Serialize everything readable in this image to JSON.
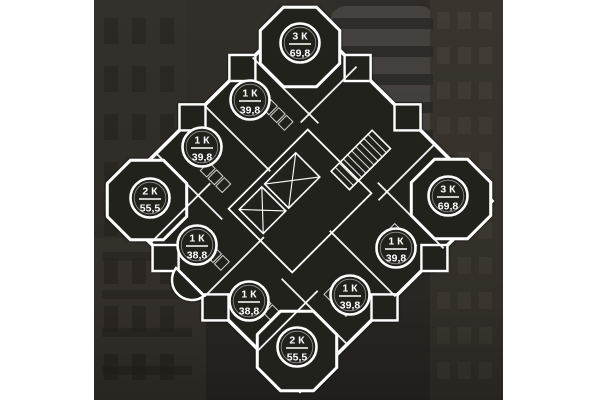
{
  "background": {
    "canvas": "#ffffff",
    "photo_base": "#2e2b28",
    "photo_left": 94,
    "photo_right": 503
  },
  "plan": {
    "colors": {
      "wall": "#ffffff",
      "interior": "#24211f",
      "text": "#ffffff"
    },
    "apartments": [
      {
        "rooms": "3 К",
        "area": "69,8",
        "cx": 300,
        "cy": 43
      },
      {
        "rooms": "1 К",
        "area": "39,8",
        "cx": 250,
        "cy": 100
      },
      {
        "rooms": "1 К",
        "area": "39,8",
        "cx": 202,
        "cy": 147
      },
      {
        "rooms": "2 К",
        "area": "55,5",
        "cx": 150,
        "cy": 198
      },
      {
        "rooms": "1 К",
        "area": "38,8",
        "cx": 197,
        "cy": 245
      },
      {
        "rooms": "1 К",
        "area": "38,8",
        "cx": 249,
        "cy": 301
      },
      {
        "rooms": "2 К",
        "area": "55,5",
        "cx": 297,
        "cy": 347
      },
      {
        "rooms": "1 К",
        "area": "39,8",
        "cx": 350,
        "cy": 295
      },
      {
        "rooms": "1 К",
        "area": "39,8",
        "cx": 396,
        "cy": 248
      },
      {
        "rooms": "3 К",
        "area": "69,8",
        "cx": 448,
        "cy": 196
      }
    ]
  }
}
